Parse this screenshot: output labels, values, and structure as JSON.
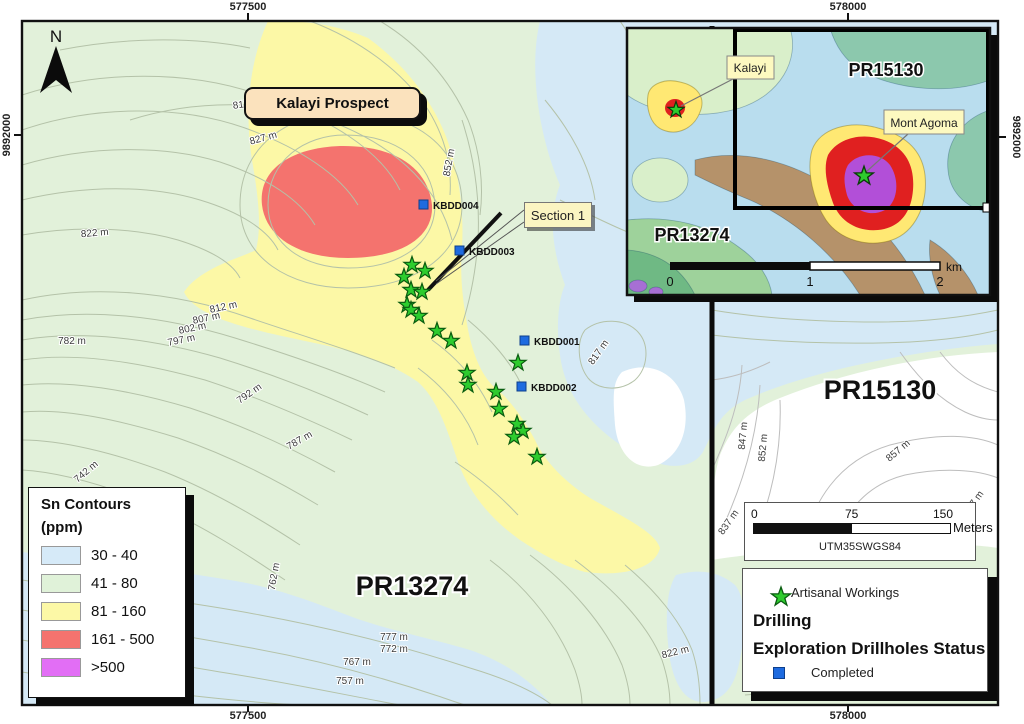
{
  "map": {
    "north_label": "N",
    "prospect_label": "Kalayi Prospect",
    "section_label": "Section 1",
    "pr13274": "PR13274",
    "pr15130": "PR15130",
    "coords": {
      "top_left": "577500",
      "top_right": "578000",
      "bottom_left": "577500",
      "bottom_right": "578000",
      "left": "9892000",
      "right": "9892000"
    },
    "drillholes": [
      "KBDD004",
      "KBDD003",
      "KBDD001",
      "KBDD002"
    ],
    "elevation_labels": [
      "817 m",
      "827 m",
      "822 m",
      "852 m",
      "812 m",
      "807 m",
      "802 m",
      "797 m",
      "782 m",
      "792 m",
      "787 m",
      "817 m",
      "847 m",
      "852 m",
      "857 m",
      "837 m",
      "857 m",
      "762 m",
      "822 m",
      "777 m",
      "772 m",
      "767 m",
      "757 m",
      "742 m"
    ]
  },
  "legend_sn": {
    "title_line1": "Sn Contours",
    "title_line2": "(ppm)",
    "classes": [
      {
        "label": "30 - 40",
        "color": "#d6eaf8"
      },
      {
        "label": "41 - 80",
        "color": "#e0f2d9"
      },
      {
        "label": "81 - 160",
        "color": "#fcf8a6"
      },
      {
        "label": "161 - 500",
        "color": "#f4736e"
      },
      {
        "label": ">500",
        "color": "#e26ef5"
      }
    ]
  },
  "scalebar": {
    "zero": "0",
    "mid": "75",
    "end": "150",
    "unit": "Meters",
    "datum": "UTM35SWGS84"
  },
  "legend_drilling": {
    "artisanal_label": "Artisanal Workings",
    "drilling_header": "Drilling",
    "status_header": "Exploration Drillholes Status",
    "completed_label": "Completed",
    "star_color": "#2ecc2e",
    "square_color": "#1e6be0"
  },
  "inset": {
    "kalayi_label": "Kalayi",
    "mont_agoma_label": "Mont Agoma",
    "pr15130": "PR15130",
    "pr13274": "PR13274",
    "scalebar": {
      "zero": "0",
      "one": "1",
      "two": "2",
      "unit": "km"
    }
  }
}
